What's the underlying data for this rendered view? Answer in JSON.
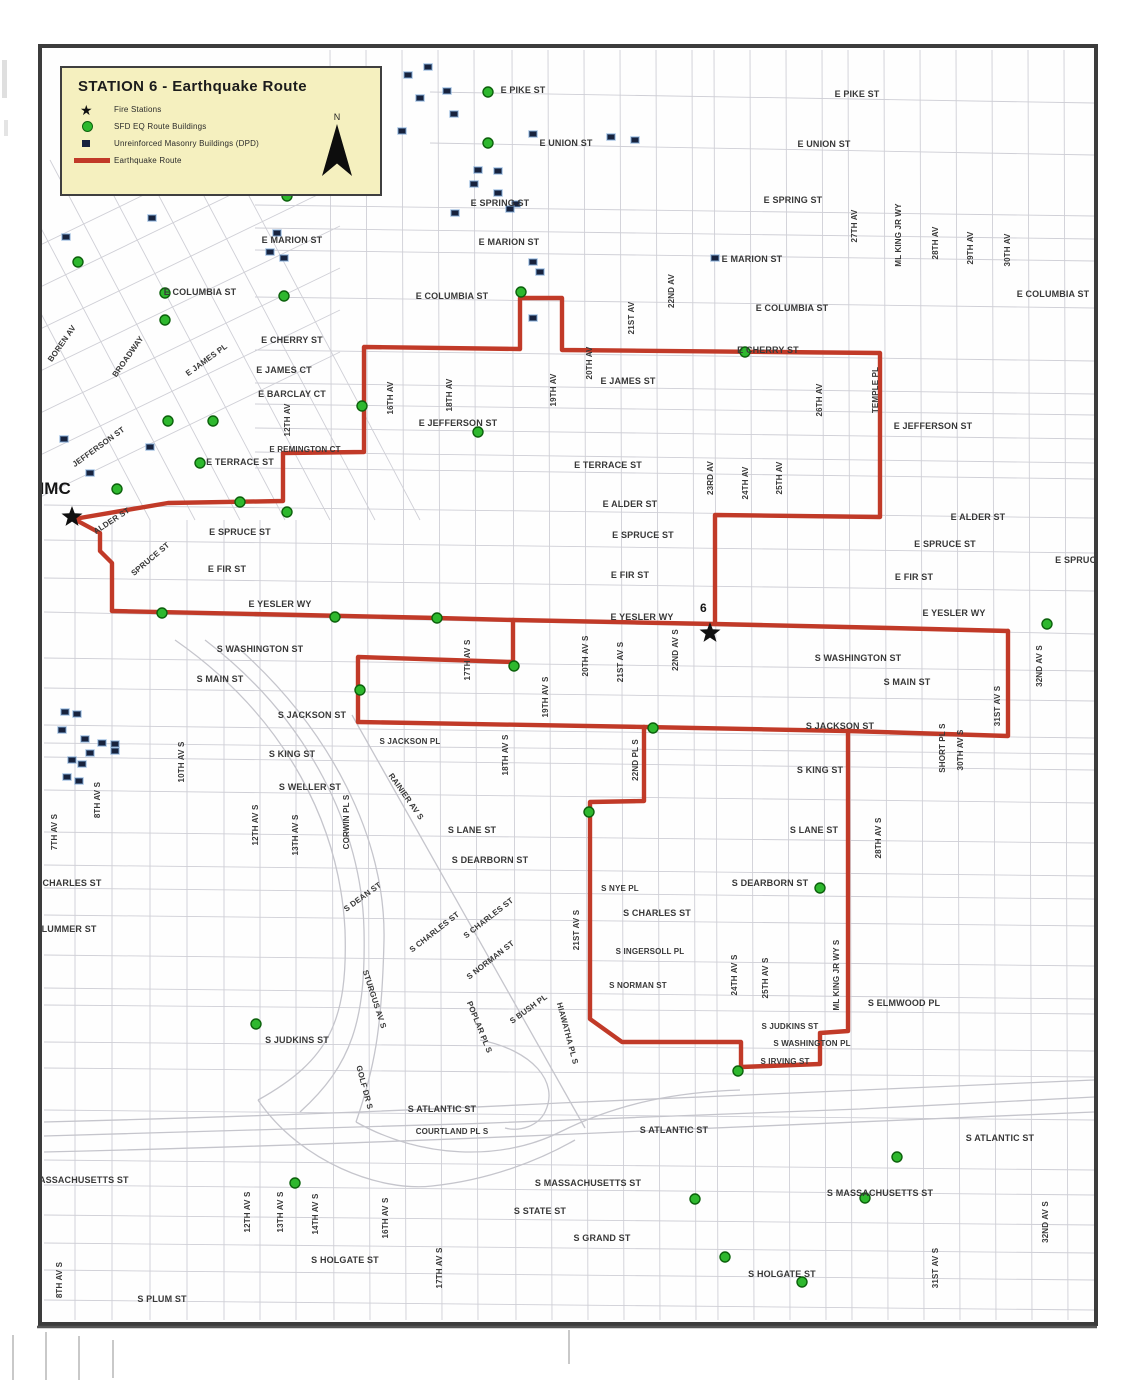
{
  "legend": {
    "title": "STATION 6 - Earthquake Route",
    "north_label": "N",
    "items": [
      {
        "label": "Fire Stations",
        "swatch": "star"
      },
      {
        "label": "SFD EQ Route Buildings",
        "swatch": "green-dot"
      },
      {
        "label": "Unreinforced Masonry Buildings (DPD)",
        "swatch": "navy-square"
      },
      {
        "label": "Earthquake Route",
        "swatch": "red-line"
      }
    ]
  },
  "map": {
    "colors": {
      "route": "#c13a28",
      "eq_building": "#2eb82e",
      "eq_building_edge": "#0c610c",
      "urm": "#17223d",
      "urm_halo": "rgba(125,168,215,0.6)",
      "label": "#383838",
      "star": "#101010"
    },
    "fire_stations": [
      {
        "label": "HMC",
        "x": 72,
        "y": 517,
        "lx": 32,
        "ly": 494,
        "ls": 17
      },
      {
        "label": "6",
        "x": 710,
        "y": 633,
        "lx": 700,
        "ly": 612,
        "ls": 12
      }
    ],
    "route_paths": [
      [
        [
          112,
          611
        ],
        [
          300,
          615
        ],
        [
          437,
          618
        ],
        [
          513,
          620
        ],
        [
          715,
          624
        ],
        [
          890,
          628
        ],
        [
          1008,
          631
        ]
      ],
      [
        [
          74,
          519
        ],
        [
          100,
          533
        ],
        [
          100,
          551
        ],
        [
          112,
          563
        ],
        [
          112,
          611
        ]
      ],
      [
        [
          74,
          519
        ],
        [
          168,
          503
        ],
        [
          283,
          501
        ],
        [
          283,
          453
        ],
        [
          364,
          452
        ],
        [
          364,
          347
        ],
        [
          520,
          349
        ],
        [
          520,
          298
        ],
        [
          562,
          298
        ],
        [
          562,
          350
        ],
        [
          880,
          353
        ],
        [
          880,
          517
        ],
        [
          715,
          515
        ],
        [
          715,
          624
        ]
      ],
      [
        [
          1008,
          631
        ],
        [
          1008,
          736
        ],
        [
          848,
          731
        ]
      ],
      [
        [
          848,
          731
        ],
        [
          644,
          727
        ],
        [
          358,
          722
        ]
      ],
      [
        [
          358,
          722
        ],
        [
          358,
          657
        ],
        [
          513,
          662
        ],
        [
          513,
          620
        ]
      ],
      [
        [
          848,
          731
        ],
        [
          848,
          1031
        ],
        [
          820,
          1033
        ],
        [
          820,
          1064
        ],
        [
          741,
          1067
        ],
        [
          741,
          1042
        ],
        [
          622,
          1042
        ],
        [
          590,
          1019
        ],
        [
          590,
          802
        ],
        [
          644,
          801
        ],
        [
          644,
          727
        ]
      ]
    ],
    "eq_buildings": [
      [
        488,
        92
      ],
      [
        488,
        143
      ],
      [
        287,
        196
      ],
      [
        78,
        262
      ],
      [
        165,
        293
      ],
      [
        165,
        320
      ],
      [
        284,
        296
      ],
      [
        521,
        292
      ],
      [
        745,
        352
      ],
      [
        362,
        406
      ],
      [
        478,
        432
      ],
      [
        168,
        421
      ],
      [
        213,
        421
      ],
      [
        200,
        463
      ],
      [
        117,
        489
      ],
      [
        240,
        502
      ],
      [
        287,
        512
      ],
      [
        162,
        613
      ],
      [
        335,
        617
      ],
      [
        437,
        618
      ],
      [
        514,
        666
      ],
      [
        360,
        690
      ],
      [
        653,
        728
      ],
      [
        589,
        812
      ],
      [
        820,
        888
      ],
      [
        1047,
        624
      ],
      [
        738,
        1071
      ],
      [
        256,
        1024
      ],
      [
        295,
        1183
      ],
      [
        695,
        1199
      ],
      [
        725,
        1257
      ],
      [
        802,
        1282
      ],
      [
        897,
        1157
      ],
      [
        865,
        1198
      ]
    ],
    "urm_buildings": [
      [
        62,
        234
      ],
      [
        148,
        215
      ],
      [
        273,
        230
      ],
      [
        266,
        249
      ],
      [
        280,
        255
      ],
      [
        404,
        72
      ],
      [
        424,
        64
      ],
      [
        443,
        88
      ],
      [
        416,
        95
      ],
      [
        398,
        128
      ],
      [
        450,
        111
      ],
      [
        529,
        131
      ],
      [
        607,
        134
      ],
      [
        631,
        137
      ],
      [
        474,
        167
      ],
      [
        494,
        168
      ],
      [
        470,
        181
      ],
      [
        494,
        190
      ],
      [
        512,
        201
      ],
      [
        451,
        210
      ],
      [
        506,
        206
      ],
      [
        529,
        259
      ],
      [
        536,
        269
      ],
      [
        529,
        315
      ],
      [
        711,
        255
      ],
      [
        60,
        436
      ],
      [
        146,
        444
      ],
      [
        86,
        470
      ],
      [
        61,
        709
      ],
      [
        73,
        711
      ],
      [
        58,
        727
      ],
      [
        81,
        736
      ],
      [
        98,
        740
      ],
      [
        111,
        741
      ],
      [
        68,
        757
      ],
      [
        78,
        761
      ],
      [
        63,
        774
      ],
      [
        75,
        778
      ],
      [
        86,
        750
      ],
      [
        111,
        748
      ]
    ],
    "street_labels": [
      {
        "t": "E PIKE ST",
        "x": 523,
        "y": 93
      },
      {
        "t": "E PIKE ST",
        "x": 857,
        "y": 97
      },
      {
        "t": "E UNION ST",
        "x": 566,
        "y": 146
      },
      {
        "t": "E UNION ST",
        "x": 824,
        "y": 147
      },
      {
        "t": "E SPRING ST",
        "x": 500,
        "y": 206
      },
      {
        "t": "E SPRING ST",
        "x": 793,
        "y": 203
      },
      {
        "t": "E MARION ST",
        "x": 292,
        "y": 243
      },
      {
        "t": "E MARION ST",
        "x": 509,
        "y": 245
      },
      {
        "t": "E MARION ST",
        "x": 752,
        "y": 262
      },
      {
        "t": "E COLUMBIA ST",
        "x": 200,
        "y": 295
      },
      {
        "t": "E COLUMBIA ST",
        "x": 452,
        "y": 299
      },
      {
        "t": "E COLUMBIA ST",
        "x": 792,
        "y": 311
      },
      {
        "t": "E COLUMBIA ST",
        "x": 1053,
        "y": 297
      },
      {
        "t": "E CHERRY ST",
        "x": 292,
        "y": 343
      },
      {
        "t": "E CHERRY ST",
        "x": 768,
        "y": 353
      },
      {
        "t": "E JAMES PL",
        "x": 208,
        "y": 362,
        "r": -36,
        "s": 8
      },
      {
        "t": "E JAMES CT",
        "x": 284,
        "y": 373
      },
      {
        "t": "E JAMES ST",
        "x": 628,
        "y": 384
      },
      {
        "t": "E BARCLAY CT",
        "x": 292,
        "y": 397
      },
      {
        "t": "E JEFFERSON ST",
        "x": 458,
        "y": 426
      },
      {
        "t": "E JEFFERSON ST",
        "x": 933,
        "y": 429
      },
      {
        "t": "E REMINGTON CT",
        "x": 305,
        "y": 452,
        "s": 8
      },
      {
        "t": "E TERRACE ST",
        "x": 240,
        "y": 465
      },
      {
        "t": "E TERRACE ST",
        "x": 608,
        "y": 468
      },
      {
        "t": "ALDER ST",
        "x": 113,
        "y": 523,
        "r": -33,
        "s": 8
      },
      {
        "t": "E ALDER ST",
        "x": 630,
        "y": 507
      },
      {
        "t": "E ALDER ST",
        "x": 978,
        "y": 520
      },
      {
        "t": "E SPRUCE ST",
        "x": 240,
        "y": 535
      },
      {
        "t": "E SPRUCE ST",
        "x": 643,
        "y": 538
      },
      {
        "t": "E SPRUCE ST",
        "x": 945,
        "y": 547
      },
      {
        "t": "E SPRUCE ST",
        "x": 1086,
        "y": 563
      },
      {
        "t": "SPRUCE ST",
        "x": 152,
        "y": 561,
        "r": -40,
        "s": 8
      },
      {
        "t": "E FIR ST",
        "x": 227,
        "y": 572
      },
      {
        "t": "E FIR ST",
        "x": 630,
        "y": 578
      },
      {
        "t": "E FIR ST",
        "x": 914,
        "y": 580
      },
      {
        "t": "E YESLER WY",
        "x": 280,
        "y": 607
      },
      {
        "t": "E YESLER WY",
        "x": 642,
        "y": 620
      },
      {
        "t": "E YESLER WY",
        "x": 954,
        "y": 616
      },
      {
        "t": "S WASHINGTON ST",
        "x": 260,
        "y": 652
      },
      {
        "t": "S WASHINGTON ST",
        "x": 858,
        "y": 661
      },
      {
        "t": "S MAIN ST",
        "x": 220,
        "y": 682
      },
      {
        "t": "S MAIN ST",
        "x": 907,
        "y": 685
      },
      {
        "t": "S JACKSON ST",
        "x": 312,
        "y": 718
      },
      {
        "t": "S JACKSON ST",
        "x": 840,
        "y": 729
      },
      {
        "t": "S JACKSON PL",
        "x": 410,
        "y": 744,
        "s": 8
      },
      {
        "t": "S KING ST",
        "x": 292,
        "y": 757
      },
      {
        "t": "S KING ST",
        "x": 820,
        "y": 773
      },
      {
        "t": "S WELLER ST",
        "x": 310,
        "y": 790
      },
      {
        "t": "S LANE ST",
        "x": 472,
        "y": 833
      },
      {
        "t": "S LANE ST",
        "x": 814,
        "y": 833
      },
      {
        "t": "S DEARBORN ST",
        "x": 490,
        "y": 863
      },
      {
        "t": "S DEARBORN ST",
        "x": 770,
        "y": 886
      },
      {
        "t": "S DEAN ST",
        "x": 364,
        "y": 899,
        "r": -36,
        "s": 8
      },
      {
        "t": "S NYE PL",
        "x": 620,
        "y": 891,
        "s": 8
      },
      {
        "t": "S CHARLES ST",
        "x": 657,
        "y": 916
      },
      {
        "t": "S CHARLES ST",
        "x": 436,
        "y": 934,
        "r": -38,
        "s": 8
      },
      {
        "t": "S CHARLES ST",
        "x": 490,
        "y": 920,
        "r": -38,
        "s": 8
      },
      {
        "t": "S INGERSOLL PL",
        "x": 650,
        "y": 954,
        "s": 8
      },
      {
        "t": "S NORMAN ST",
        "x": 638,
        "y": 988,
        "s": 8
      },
      {
        "t": "S NORMAN ST",
        "x": 492,
        "y": 962,
        "r": -38,
        "s": 8
      },
      {
        "t": "S ELMWOOD PL",
        "x": 904,
        "y": 1006
      },
      {
        "t": "S JUDKINS ST",
        "x": 297,
        "y": 1043
      },
      {
        "t": "S JUDKINS ST",
        "x": 790,
        "y": 1029,
        "s": 8
      },
      {
        "t": "S WASHINGTON PL",
        "x": 812,
        "y": 1046,
        "s": 8
      },
      {
        "t": "S IRVING ST",
        "x": 785,
        "y": 1064,
        "s": 8
      },
      {
        "t": "S ATLANTIC ST",
        "x": 442,
        "y": 1112
      },
      {
        "t": "S ATLANTIC ST",
        "x": 674,
        "y": 1133
      },
      {
        "t": "S ATLANTIC ST",
        "x": 1000,
        "y": 1141
      },
      {
        "t": "S MASSACHUSETTS ST",
        "x": 588,
        "y": 1186
      },
      {
        "t": "S MASSACHUSETTS ST",
        "x": 880,
        "y": 1196
      },
      {
        "t": "MASSACHUSETTS ST",
        "x": 80,
        "y": 1183
      },
      {
        "t": "S STATE ST",
        "x": 540,
        "y": 1214
      },
      {
        "t": "S GRAND ST",
        "x": 602,
        "y": 1241
      },
      {
        "t": "S HOLGATE ST",
        "x": 345,
        "y": 1263
      },
      {
        "t": "S HOLGATE ST",
        "x": 782,
        "y": 1277
      },
      {
        "t": "S PLUM ST",
        "x": 162,
        "y": 1302
      },
      {
        "t": "CHARLES ST",
        "x": 72,
        "y": 886
      },
      {
        "t": "PLUMMER ST",
        "x": 66,
        "y": 932
      },
      {
        "t": "COURTLAND PL S",
        "x": 452,
        "y": 1134,
        "s": 8
      },
      {
        "t": "BOREN AV",
        "x": 64,
        "y": 345,
        "r": -55,
        "s": 8
      },
      {
        "t": "BROADWAY",
        "x": 130,
        "y": 358,
        "r": -55,
        "s": 8
      },
      {
        "t": "JEFFERSON ST",
        "x": 100,
        "y": 449,
        "r": -36,
        "s": 8
      },
      {
        "t": "STURGUS AV S",
        "x": 372,
        "y": 1000,
        "r": 72,
        "s": 8
      },
      {
        "t": "POPLAR PL S",
        "x": 477,
        "y": 1028,
        "r": 68,
        "s": 8
      },
      {
        "t": "S BUSH PL",
        "x": 530,
        "y": 1011,
        "r": -36,
        "s": 8
      },
      {
        "t": "HIAWATHA PL S",
        "x": 565,
        "y": 1034,
        "r": 75,
        "s": 8
      },
      {
        "t": "RAINIER AV S",
        "x": 404,
        "y": 798,
        "r": 55,
        "s": 8
      },
      {
        "t": "CORWIN PL S",
        "x": 349,
        "y": 822,
        "r": -90,
        "s": 8
      },
      {
        "t": "GOLF DR S",
        "x": 362,
        "y": 1088,
        "r": 75,
        "s": 8
      },
      {
        "t": "12TH AV",
        "x": 290,
        "y": 420,
        "r": -90,
        "s": 8
      },
      {
        "t": "16TH AV",
        "x": 393,
        "y": 398,
        "r": -90,
        "s": 8
      },
      {
        "t": "18TH AV",
        "x": 452,
        "y": 395,
        "r": -90,
        "s": 8
      },
      {
        "t": "19TH AV",
        "x": 556,
        "y": 390,
        "r": -90,
        "s": 8
      },
      {
        "t": "20TH AV",
        "x": 592,
        "y": 363,
        "r": -90,
        "s": 8
      },
      {
        "t": "21ST AV",
        "x": 634,
        "y": 318,
        "r": -90,
        "s": 8
      },
      {
        "t": "22ND AV",
        "x": 674,
        "y": 291,
        "r": -90,
        "s": 8
      },
      {
        "t": "23RD AV",
        "x": 713,
        "y": 478,
        "r": -90,
        "s": 8
      },
      {
        "t": "24TH AV",
        "x": 748,
        "y": 483,
        "r": -90,
        "s": 8
      },
      {
        "t": "25TH AV",
        "x": 782,
        "y": 478,
        "r": -90,
        "s": 8
      },
      {
        "t": "26TH AV",
        "x": 822,
        "y": 400,
        "r": -90,
        "s": 8
      },
      {
        "t": "27TH AV",
        "x": 857,
        "y": 226,
        "r": -90,
        "s": 8
      },
      {
        "t": "ML KING JR WY",
        "x": 901,
        "y": 235,
        "r": -90,
        "s": 8
      },
      {
        "t": "28TH AV",
        "x": 938,
        "y": 243,
        "r": -90,
        "s": 8
      },
      {
        "t": "29TH AV",
        "x": 973,
        "y": 248,
        "r": -90,
        "s": 8
      },
      {
        "t": "30TH AV",
        "x": 1010,
        "y": 250,
        "r": -90,
        "s": 8
      },
      {
        "t": "TEMPLE PL",
        "x": 878,
        "y": 390,
        "r": -90,
        "s": 8
      },
      {
        "t": "17TH AV S",
        "x": 470,
        "y": 660,
        "r": -90,
        "s": 8
      },
      {
        "t": "18TH AV S",
        "x": 508,
        "y": 755,
        "r": -90,
        "s": 8
      },
      {
        "t": "19TH AV S",
        "x": 548,
        "y": 697,
        "r": -90,
        "s": 8
      },
      {
        "t": "20TH AV S",
        "x": 588,
        "y": 656,
        "r": -90,
        "s": 8
      },
      {
        "t": "21ST AV S",
        "x": 623,
        "y": 662,
        "r": -90,
        "s": 8
      },
      {
        "t": "22ND AV S",
        "x": 678,
        "y": 650,
        "r": -90,
        "s": 8
      },
      {
        "t": "22ND PL S",
        "x": 638,
        "y": 760,
        "r": -90,
        "s": 8
      },
      {
        "t": "21ST AV S",
        "x": 579,
        "y": 930,
        "r": -90,
        "s": 8
      },
      {
        "t": "24TH AV S",
        "x": 737,
        "y": 975,
        "r": -90,
        "s": 8
      },
      {
        "t": "25TH AV S",
        "x": 768,
        "y": 978,
        "r": -90,
        "s": 8
      },
      {
        "t": "ML KING JR WY S",
        "x": 839,
        "y": 975,
        "r": -90,
        "s": 8
      },
      {
        "t": "28TH AV S",
        "x": 881,
        "y": 838,
        "r": -90,
        "s": 8
      },
      {
        "t": "SHORT PL S",
        "x": 945,
        "y": 748,
        "r": -90,
        "s": 8
      },
      {
        "t": "30TH AV S",
        "x": 963,
        "y": 750,
        "r": -90,
        "s": 8
      },
      {
        "t": "31ST AV S",
        "x": 1000,
        "y": 706,
        "r": -90,
        "s": 8
      },
      {
        "t": "32ND AV S",
        "x": 1042,
        "y": 666,
        "r": -90,
        "s": 8
      },
      {
        "t": "7TH AV S",
        "x": 57,
        "y": 832,
        "r": -90,
        "s": 8
      },
      {
        "t": "8TH AV S",
        "x": 100,
        "y": 800,
        "r": -90,
        "s": 8
      },
      {
        "t": "10TH AV S",
        "x": 184,
        "y": 762,
        "r": -90,
        "s": 8
      },
      {
        "t": "12TH AV S",
        "x": 258,
        "y": 825,
        "r": -90,
        "s": 8
      },
      {
        "t": "13TH AV S",
        "x": 298,
        "y": 835,
        "r": -90,
        "s": 8
      },
      {
        "t": "8TH AV S",
        "x": 62,
        "y": 1280,
        "r": -90,
        "s": 8
      },
      {
        "t": "12TH AV S",
        "x": 250,
        "y": 1212,
        "r": -90,
        "s": 8
      },
      {
        "t": "13TH AV S",
        "x": 283,
        "y": 1212,
        "r": -90,
        "s": 8
      },
      {
        "t": "14TH AV S",
        "x": 318,
        "y": 1214,
        "r": -90,
        "s": 8
      },
      {
        "t": "16TH AV S",
        "x": 388,
        "y": 1218,
        "r": -90,
        "s": 8
      },
      {
        "t": "17TH AV S",
        "x": 442,
        "y": 1268,
        "r": -90,
        "s": 8
      },
      {
        "t": "31ST AV S",
        "x": 938,
        "y": 1268,
        "r": -90,
        "s": 8
      },
      {
        "t": "32ND AV S",
        "x": 1048,
        "y": 1222,
        "r": -90,
        "s": 8
      }
    ]
  }
}
